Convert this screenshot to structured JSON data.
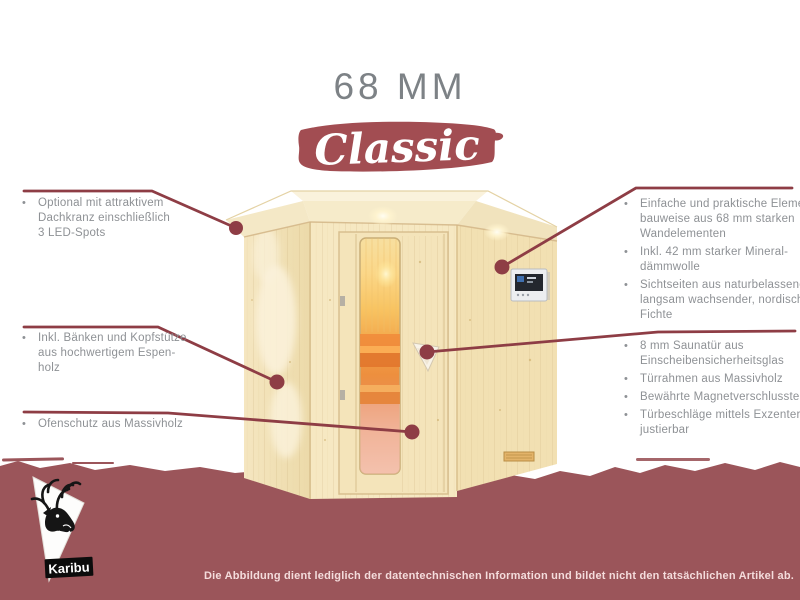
{
  "header": {
    "title": "68 MM",
    "badge_label": "Classic"
  },
  "bullet_char": "•",
  "colors": {
    "bottom_banner_red": "#9b555a",
    "badge_red": "#a24d52",
    "pointer_red": "#8e3d45",
    "annotation_text_gray": "#8e9195",
    "title_gray": "#7d8286",
    "wood_light": "#f6e8c2"
  },
  "left_annotations": [
    {
      "lines": [
        "Optional mit attraktivem",
        "Dachkranz einschließlich",
        "3 LED-Spots"
      ]
    },
    {
      "lines": [
        "Inkl. Bänken und Kopfstütze",
        "aus hochwertigem Espen-",
        "holz"
      ]
    },
    {
      "lines": [
        "Ofenschutz aus Massivholz"
      ]
    }
  ],
  "right_annotations": [
    {
      "items": [
        {
          "lines": [
            "Einfache und praktische Element-",
            "bauweise aus 68 mm starken",
            "Wandelementen"
          ]
        },
        {
          "lines": [
            "Inkl. 42 mm starker Mineral-",
            "dämmwolle"
          ]
        },
        {
          "lines": [
            "Sichtseiten aus naturbelassener,",
            "langsam wachsender, nordischer",
            "Fichte"
          ]
        }
      ]
    },
    {
      "items": [
        {
          "lines": [
            "8 mm Saunatür aus",
            "Einscheibensicherheitsglas"
          ]
        },
        {
          "lines": [
            "Türrahmen aus Massivholz"
          ]
        },
        {
          "lines": [
            "Bewährte Magnetverschlusstechnik"
          ]
        },
        {
          "lines": [
            "Türbeschläge mittels Exzenter",
            "justierbar"
          ]
        }
      ]
    }
  ],
  "footer": {
    "disclaimer": "Die Abbildung dient lediglich der datentechnischen Information und bildet nicht den tatsächlichen Artikel ab."
  },
  "logo": {
    "brand": "Karibu",
    "icon": "deer-head-icon"
  }
}
